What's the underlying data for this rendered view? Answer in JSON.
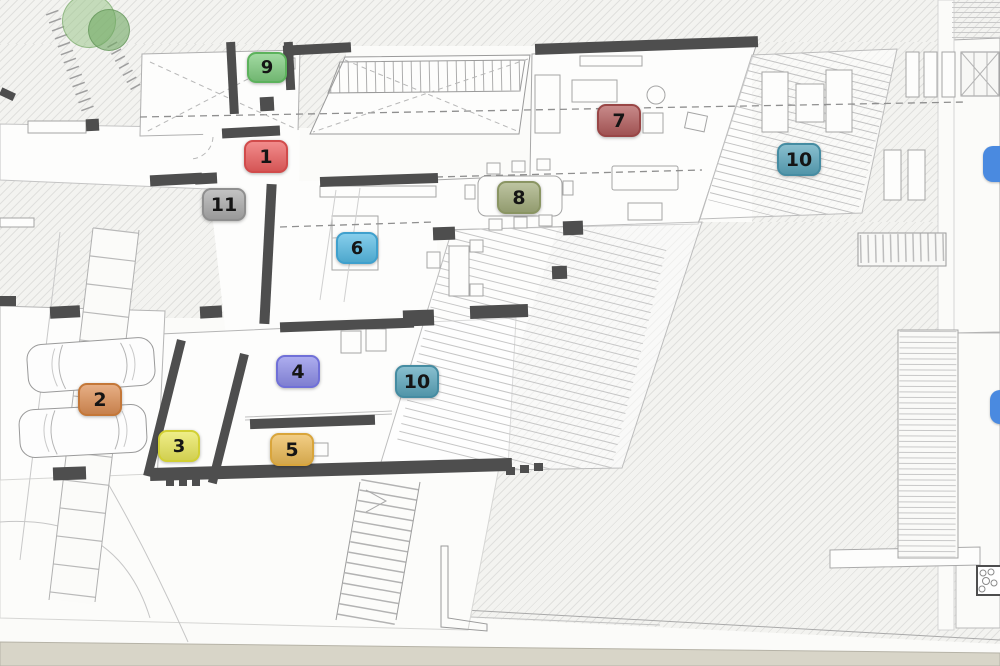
{
  "scene_title": "architectural floor plan with numbered room markers",
  "wall_color": "#4e4e4e",
  "ground_strip_color": "#d8d5c8",
  "markers": [
    {
      "label": "1",
      "x": 244,
      "y": 140,
      "w": 40,
      "h": 29,
      "bg": "#ed5f5f",
      "border": "#d14b4b"
    },
    {
      "label": "2",
      "x": 78,
      "y": 383,
      "w": 40,
      "h": 29,
      "bg": "#dd8f55",
      "border": "#c47738"
    },
    {
      "label": "3",
      "x": 158,
      "y": 430,
      "w": 38,
      "h": 28,
      "bg": "#e9e75a",
      "border": "#d2d034"
    },
    {
      "label": "4",
      "x": 276,
      "y": 355,
      "w": 40,
      "h": 29,
      "bg": "#8d8de8",
      "border": "#7070d8"
    },
    {
      "label": "5",
      "x": 270,
      "y": 433,
      "w": 40,
      "h": 29,
      "bg": "#ecba55",
      "border": "#d9a53b"
    },
    {
      "label": "6",
      "x": 336,
      "y": 232,
      "w": 38,
      "h": 28,
      "bg": "#57bbe4",
      "border": "#3fa0cd"
    },
    {
      "label": "7",
      "x": 597,
      "y": 104,
      "w": 40,
      "h": 29,
      "bg": "#b25c5c",
      "border": "#994646"
    },
    {
      "label": "8",
      "x": 497,
      "y": 181,
      "w": 40,
      "h": 29,
      "bg": "#a3ad7c",
      "border": "#8a9563"
    },
    {
      "label": "9",
      "x": 247,
      "y": 52,
      "w": 36,
      "h": 27,
      "bg": "#7ecb7e",
      "border": "#5cb25c"
    },
    {
      "label": "10",
      "x": 777,
      "y": 143,
      "w": 40,
      "h": 29,
      "bg": "#5ba6bc",
      "border": "#458ca2"
    },
    {
      "label": "10",
      "x": 395,
      "y": 365,
      "w": 40,
      "h": 29,
      "bg": "#5ba6bc",
      "border": "#458ca2"
    },
    {
      "label": "11",
      "x": 202,
      "y": 188,
      "w": 40,
      "h": 29,
      "bg": "#ababab",
      "border": "#8f8f8f"
    }
  ],
  "pool_markers": [
    {
      "x": 983,
      "y": 146,
      "w": 30,
      "h": 36
    },
    {
      "x": 990,
      "y": 390,
      "w": 26,
      "h": 34
    }
  ],
  "pool_color": "#4a8ae0",
  "trees": [
    {
      "cx": 88,
      "cy": 20,
      "r": 26,
      "fill": "rgba(150,196,132,0.5)",
      "stroke": "rgba(110,160,95,0.55)"
    },
    {
      "cx": 108,
      "cy": 29,
      "r": 20,
      "fill": "rgba(112,168,98,0.6)",
      "stroke": "rgba(90,140,80,0.6)"
    }
  ]
}
